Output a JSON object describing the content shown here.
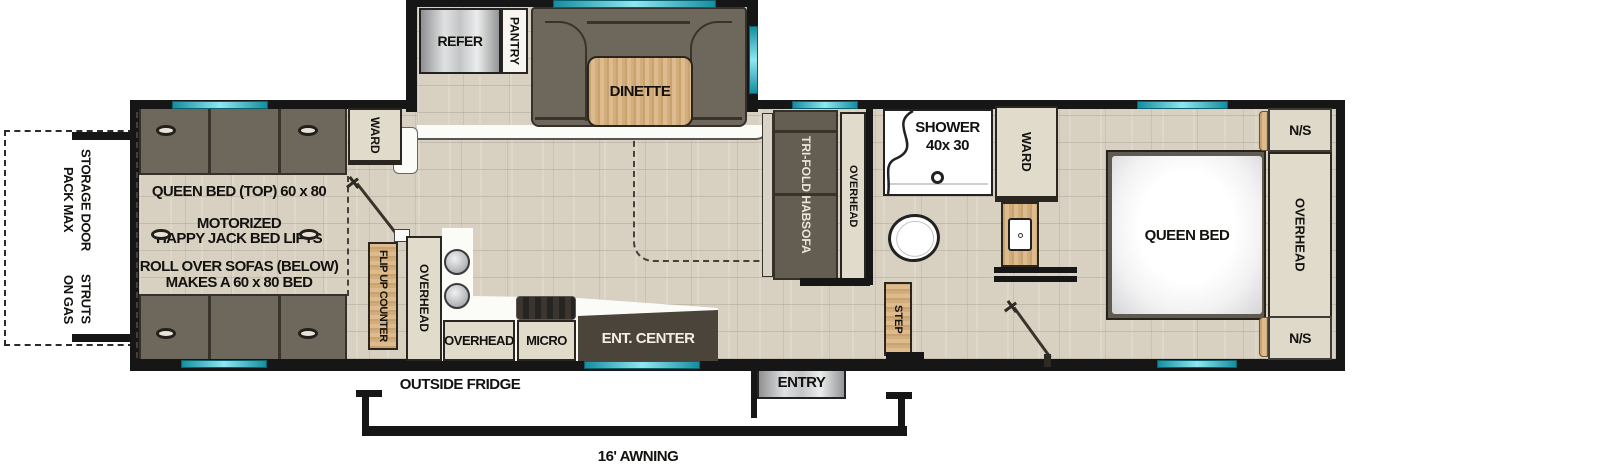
{
  "colors": {
    "window_accent": "#3fc6d8",
    "wall": "#161616",
    "floor": "#d8d1c2",
    "wood": "#d8b88c",
    "cabinet": "#e0dbcb",
    "sofa": "#6a6355",
    "entertainment_center": "#4a443b"
  },
  "exterior": {
    "storage_line1": "PACK MAX STORAGE DOOR",
    "storage_line2": "ON GAS STRUTS",
    "outside_fridge": "OUTSIDE FRIDGE",
    "entry": "ENTRY",
    "awning": "16' AWNING"
  },
  "slide": {
    "refer": "REFER",
    "pantry": "PANTRY",
    "dinette": "DINETTE"
  },
  "garage": {
    "ward": "WARD",
    "note_queen": "QUEEN BED (TOP) 60 x 80",
    "note_motorized": "MOTORIZED",
    "note_happyjack": "HAPPY JACK BED LIFTS",
    "note_rollover": "ROLL OVER SOFAS (BELOW)",
    "note_makes": "MAKES A 60 x 80 BED"
  },
  "kitchen": {
    "flip_counter": "FLIP UP COUNTER",
    "overhead_tall": "OVERHEAD",
    "overhead": "OVERHEAD",
    "micro": "MICRO",
    "ent_center": "ENT. CENTER"
  },
  "living": {
    "sofa_line1": "TRI-FOLD HAB",
    "sofa_line2": "SOFA",
    "overhead": "OVERHEAD"
  },
  "bath": {
    "shower_name": "SHOWER",
    "shower_size": "40x 30",
    "ward": "WARD",
    "step": "STEP"
  },
  "bedroom": {
    "bed": "QUEEN BED",
    "overhead": "OVERHEAD",
    "ns_top": "N/S",
    "ns_bottom": "N/S"
  }
}
